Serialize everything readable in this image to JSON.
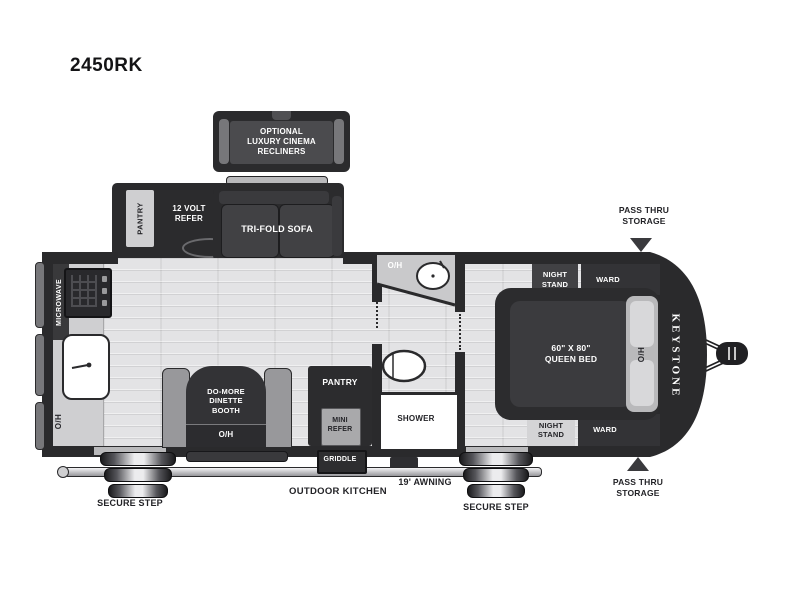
{
  "title": "2450RK",
  "labels": {
    "recliners": "OPTIONAL\nLUXURY CINEMA\nRECLINERS",
    "slide_pantry": "PANTRY",
    "refer": "12 VOLT\nREFER",
    "sofa": "TRI-FOLD SOFA",
    "microwave": "MICROWAVE",
    "kitchen_oh": "O/H",
    "dinette": "DO-MORE\nDINETTE\nBOOTH",
    "dinette_oh": "O/H",
    "pantry": "PANTRY",
    "mini_refer": "MINI\nREFER",
    "bath_oh": "O/H",
    "shower": "SHOWER",
    "bed": "60\" X 80\"\nQUEEN BED",
    "night_stand_top": "NIGHT\nSTAND",
    "ward_top": "WARD",
    "night_stand_bottom": "NIGHT\nSTAND",
    "ward_bottom": "WARD",
    "bed_oh": "O/H",
    "brand": "KEYSTONE",
    "pass_thru_top": "PASS THRU\nSTORAGE",
    "pass_thru_bottom": "PASS THRU\nSTORAGE",
    "secure_step_left": "SECURE STEP",
    "secure_step_right": "SECURE STEP",
    "outdoor_kitchen": "OUTDOOR KITCHEN",
    "awning": "19' AWNING",
    "griddle": "GRIDDLE"
  },
  "colors": {
    "wall": "#2a2a2c",
    "furniture_dark": "#333336",
    "floor": "#e3e3e5",
    "counter": "#cfcfd1",
    "label_light": "#ffffff",
    "label_dark": "#232327"
  }
}
